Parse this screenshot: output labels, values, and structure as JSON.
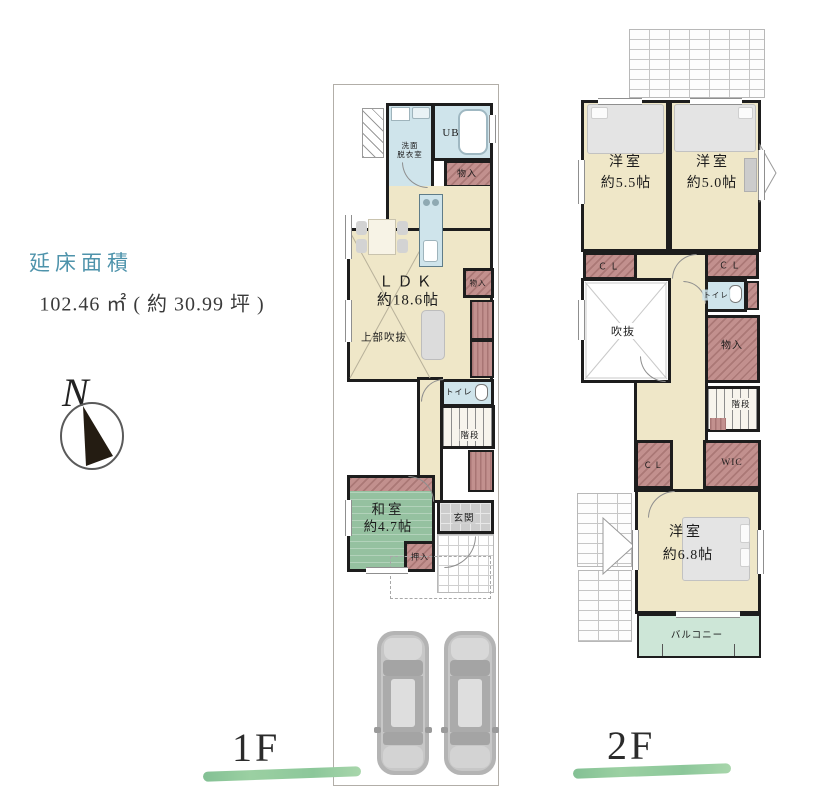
{
  "info": {
    "total_area_label": "延床面積",
    "total_area_value": "102.46 ㎡ ( 約 30.99 坪 )",
    "north_label": "N"
  },
  "floor1": {
    "label": "1F",
    "rooms": {
      "washroom_l1": "洗面",
      "washroom_l2": "脱衣室",
      "bath": "UB",
      "storage_top": "物入",
      "ldk": "ＬＤＫ",
      "ldk_size": "約18.6帖",
      "upper_void": "上部吹抜",
      "storage_mid": "物入",
      "toilet": "トイレ",
      "stairs": "階段",
      "washitsu": "和室",
      "washitsu_size": "約4.7帖",
      "oshiire": "押入",
      "genkan": "玄関"
    }
  },
  "floor2": {
    "label": "2F",
    "rooms": {
      "bedroom1": "洋室",
      "bedroom1_size": "約5.5帖",
      "bedroom2": "洋室",
      "bedroom2_size": "約5.0帖",
      "closet1": "ＣＬ",
      "closet2": "ＣＬ",
      "toilet": "トイレ",
      "void": "吹抜",
      "storage": "物入",
      "stairs": "階段",
      "closet3": "ＣＬ",
      "wic": "WIC",
      "bedroom3": "洋室",
      "bedroom3_size": "約6.8帖",
      "balcony": "バルコニー"
    }
  },
  "colors": {
    "accent_teal": "#4e93ab",
    "floor_cream": "#efe7c8",
    "closet_pink": "#c2908e",
    "tatami_green": "#95c1a0",
    "balcony_green": "#cde6d7",
    "wet_area_blue": "#cfe4eb",
    "wall_black": "#1d1d1d",
    "underline_green": "#8cc79a"
  }
}
